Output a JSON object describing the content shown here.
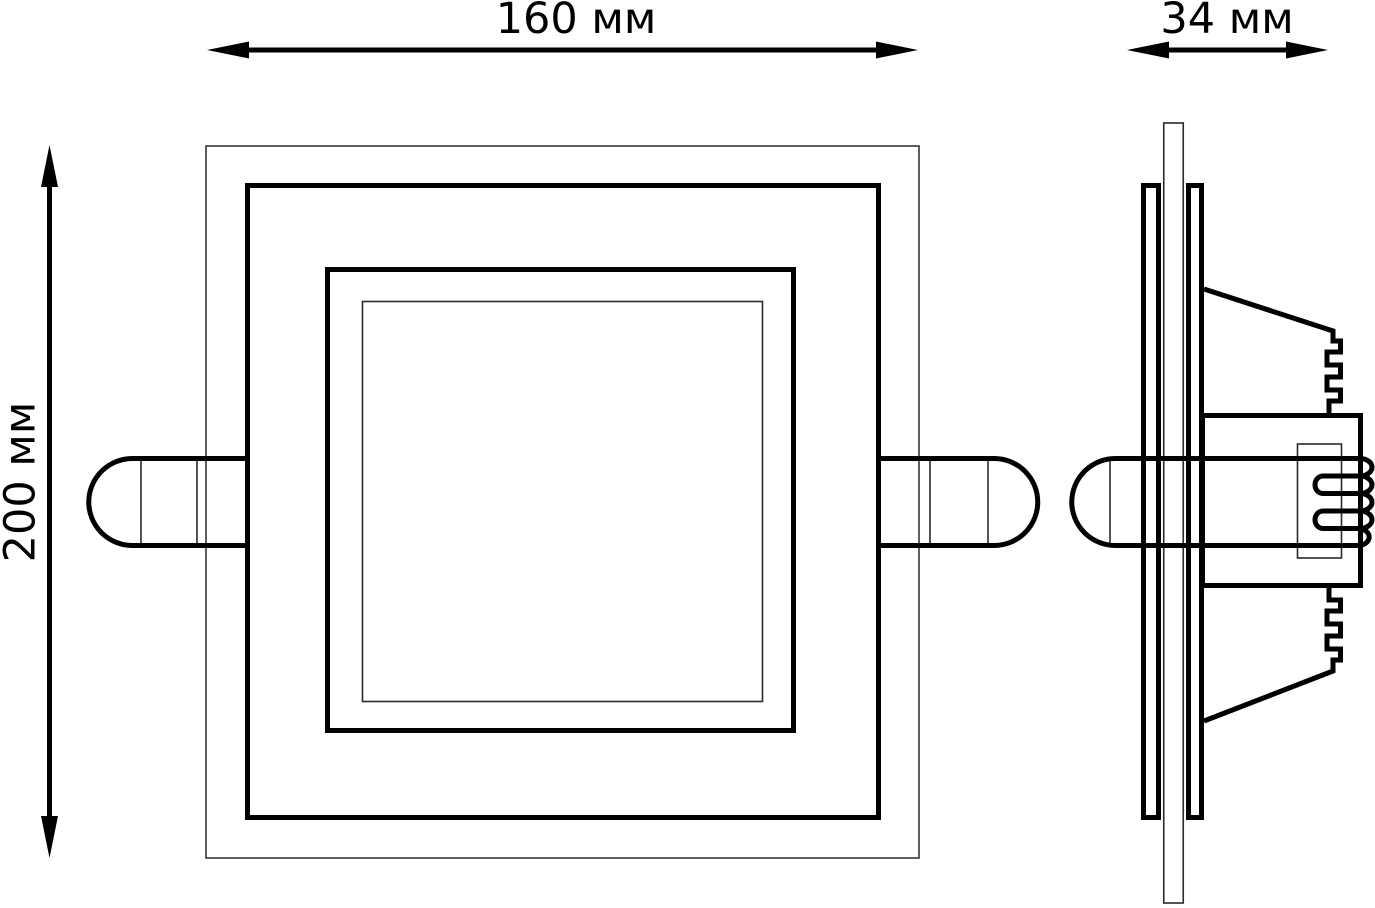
{
  "page": {
    "background": "#ffffff",
    "line_color": "#000000"
  },
  "diagram": {
    "type": "technical-dimension-drawing",
    "views": [
      "front-view",
      "side-view"
    ],
    "dimensions": {
      "width": {
        "label": "160 мм"
      },
      "depth": {
        "label": "34 мм"
      },
      "height": {
        "label": "200 мм"
      }
    }
  }
}
